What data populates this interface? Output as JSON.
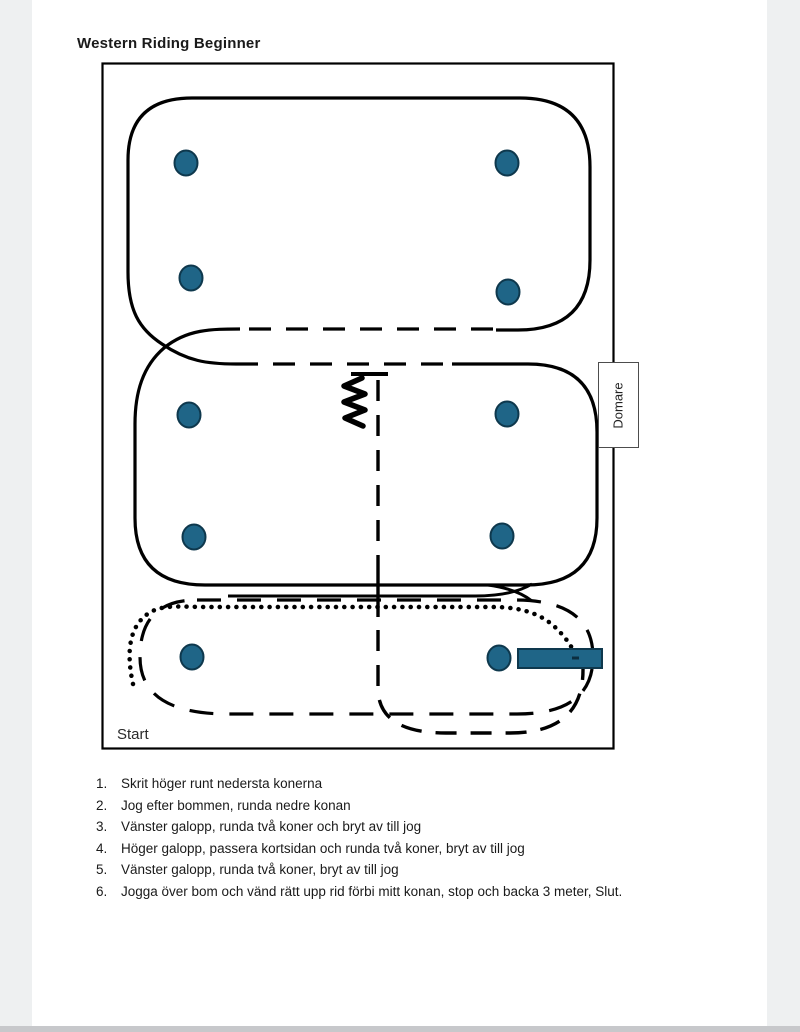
{
  "page": {
    "title": "Western Riding Beginner"
  },
  "arena": {
    "judge_label": "Domare",
    "start_label": "Start",
    "cone_count": 10,
    "obstacles": [
      "bom-pole",
      "backup-zigzag"
    ]
  },
  "instructions": {
    "items": [
      {
        "num": "1.",
        "text": "Skrit höger runt nedersta konerna"
      },
      {
        "num": "2.",
        "text": "Jog efter bommen, runda nedre konan"
      },
      {
        "num": "3.",
        "text": "Vänster galopp, runda två koner och bryt av till jog"
      },
      {
        "num": "4.",
        "text": "Höger galopp, passera kortsidan och runda två koner, bryt av till jog"
      },
      {
        "num": "5.",
        "text": "Vänster galopp, runda två koner, bryt av till jog"
      },
      {
        "num": "6.",
        "text": "Jogga över bom och vänd rätt upp rid förbi mitt konan, stop och backa 3 meter, Slut."
      }
    ]
  },
  "colors": {
    "cone": "#1f6587",
    "cone-border": "#0e384d",
    "bar": "#1f6587",
    "line": "#000000",
    "page-bg": "#ffffff",
    "viewer-bg": "#eef0f1",
    "bottom-strip": "#c7c8cb",
    "text": "#1a1a1a"
  }
}
